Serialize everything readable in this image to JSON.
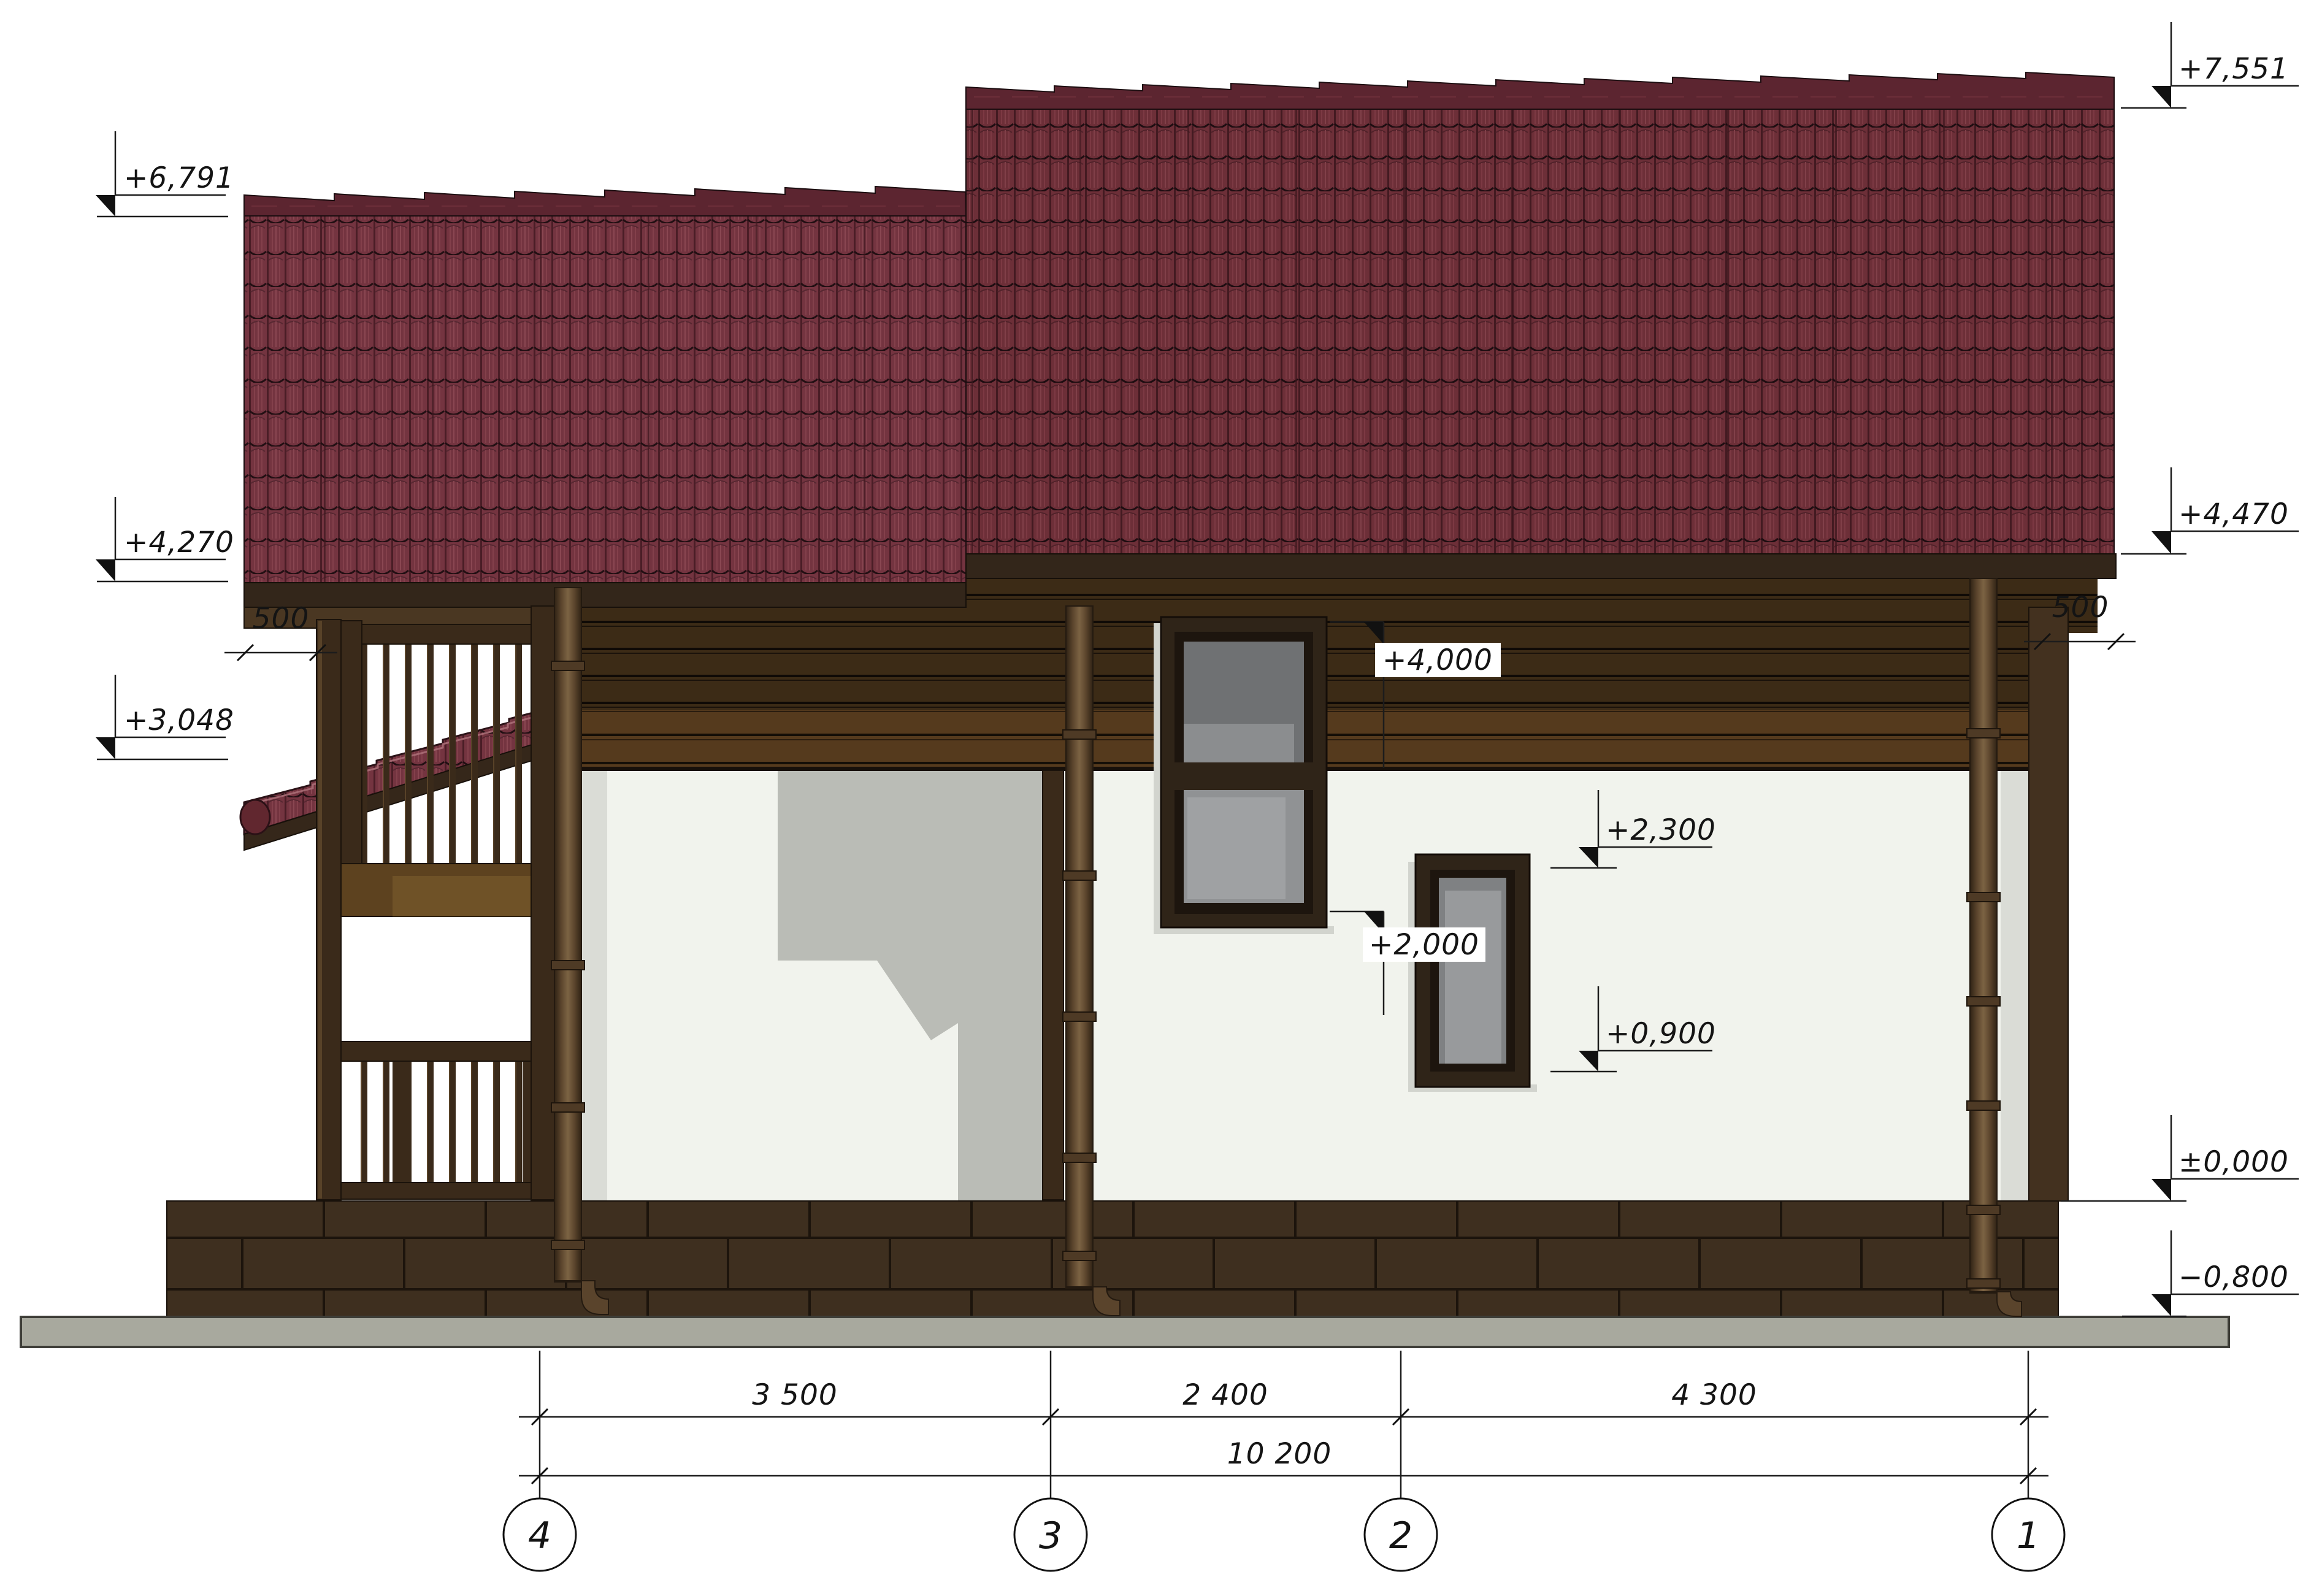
{
  "levels": {
    "p7551": "+7,551",
    "p6791": "+6,791",
    "p4470": "+4,470",
    "p4270": "+4,270",
    "p3048": "+3,048",
    "p4000": "+4,000",
    "p2300": "+2,300",
    "p2000": "+2,000",
    "p0900": "+0,900",
    "zero": "±0,000",
    "m0800": "−0,800"
  },
  "overhang_dims": {
    "left": "500",
    "right": "500"
  },
  "axis_dims": {
    "d43": "3 500",
    "d32": "2 400",
    "d21": "4 300",
    "total": "10 200"
  },
  "grid_axes": {
    "g4": "4",
    "g3": "3",
    "g2": "2",
    "g1": "1"
  },
  "palette": {
    "roof_tile": "#6d2f38",
    "roof_cap": "#5c2530",
    "siding_dark": "#3c2b16",
    "siding_light": "#553a1d",
    "stucco": "#f1f3ed",
    "foundation": "#3e2f1f",
    "ground_slab": "#a8a99e",
    "wall_shadow": "#babcb6",
    "line": "#141414"
  }
}
